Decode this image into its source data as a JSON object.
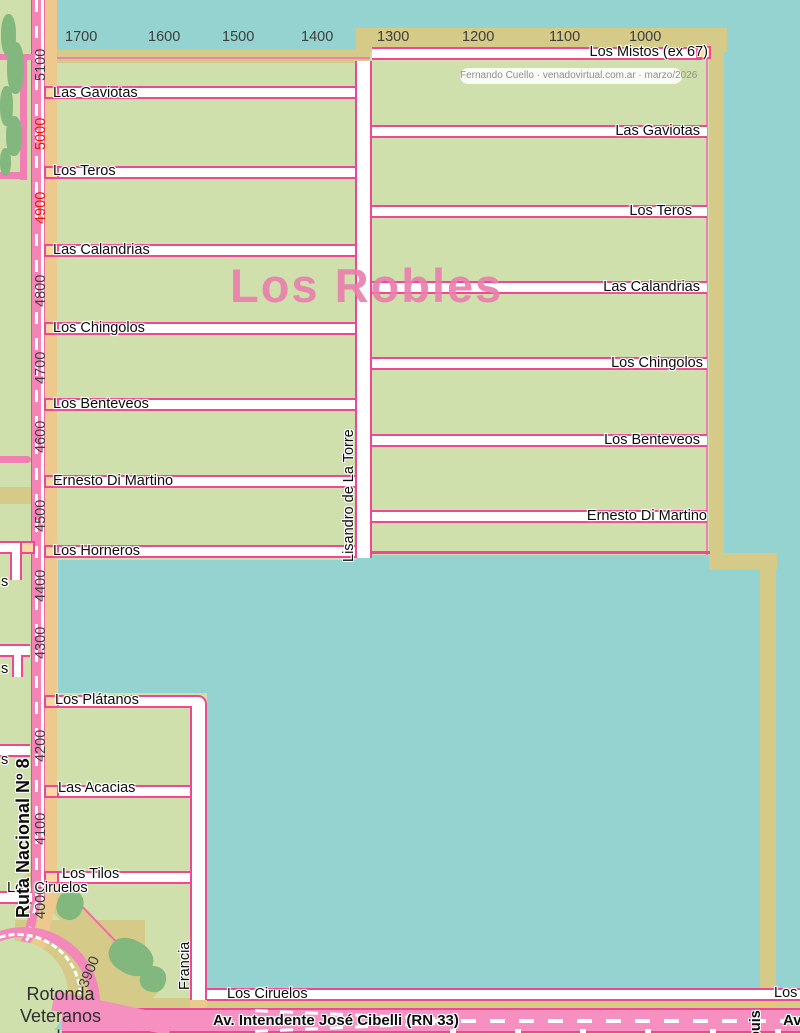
{
  "title": "Los Robles",
  "attribution": "Fernando Cuello · venadovirtual.com.ar · marzo/2026",
  "axes": {
    "top": [
      "1700",
      "1600",
      "1500",
      "1400",
      "1300",
      "1200",
      "1100",
      "1000"
    ],
    "left": [
      "5100",
      "5000",
      "4900",
      "4800",
      "4700",
      "4600",
      "4500",
      "4400",
      "4300",
      "4200",
      "4100",
      "4000",
      "3900"
    ],
    "left_red_values": [
      "5000",
      "4900"
    ]
  },
  "streets": {
    "west": [
      "Las Gaviotas",
      "Los Teros",
      "Las Calandrias",
      "Los Chingolos",
      "Los Benteveos",
      "Ernesto Di Martino",
      "Los Horneros"
    ],
    "east": [
      "Los Mistos (ex 67)",
      "Las Gaviotas",
      "Los Teros",
      "Las Calandrias",
      "Los Chingolos",
      "Los Benteveos",
      "Ernesto Di Martino"
    ],
    "south": [
      "Los Plátanos",
      "Las Acacias",
      "Los Tilos"
    ],
    "vertical": {
      "lisandro": "Lisandro de La Torre",
      "francia": "Francia",
      "ruta": "Ruta Nacional Nº 8",
      "partial_east": "puis"
    },
    "ciruelos_west": "Los Ciruelos",
    "ciruelos_south": "Los Ciruelos",
    "partial_right": "Los",
    "partial_av": "Av.",
    "edge_cut": "s"
  },
  "avenue": "Av. Intendente José Cibelli (RN 33)",
  "rotonda": {
    "line1": "Rotonda",
    "line2": "Veteranos",
    "line3": "de"
  },
  "colors": {
    "water": "#95d3d1",
    "block_green": "#cfe0ad",
    "tree_green": "#82b87d",
    "road_tan": "#d5ca87",
    "ruta_orange": "#eec98e",
    "stub_orange": "#fcd9a4",
    "road_pink_border": "#ee4795",
    "road_pink_band": "#f484b6",
    "title_pink": "#e97fac",
    "number_gray": "#3d3d3d",
    "number_red": "#e01c00"
  }
}
